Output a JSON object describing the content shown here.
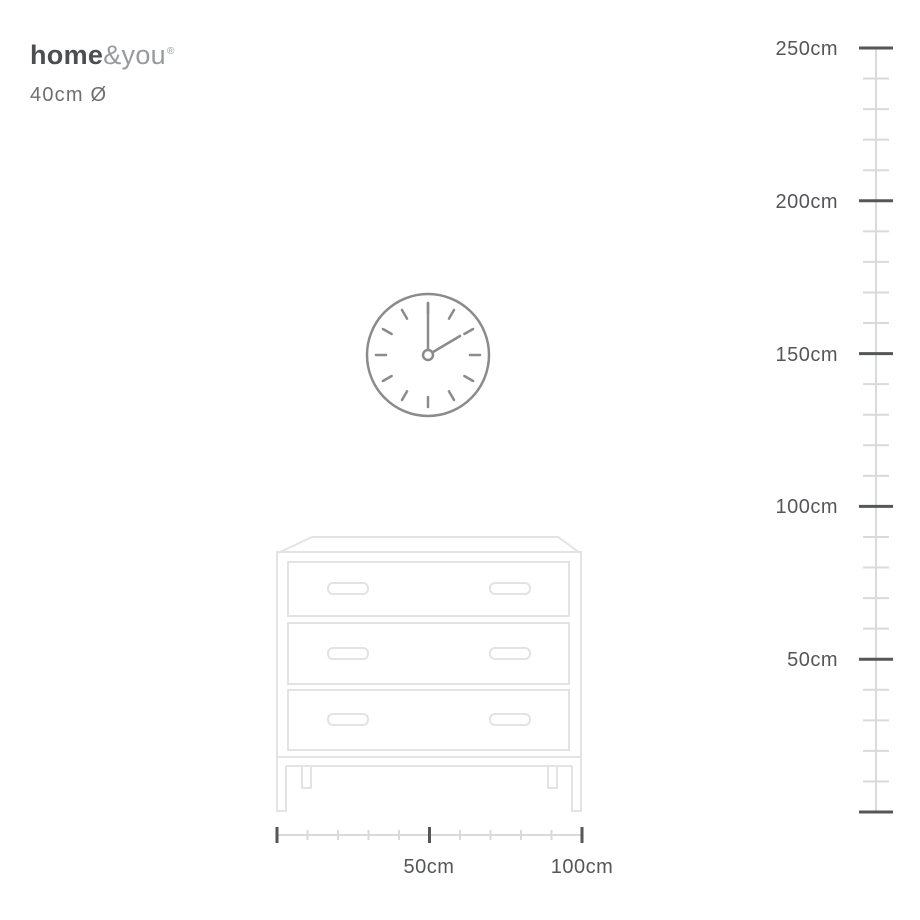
{
  "brand": {
    "name": "home&you",
    "logo_bold": "home",
    "logo_light": "&you",
    "registered_mark": "®"
  },
  "product": {
    "dimension_label": "40cm Ø"
  },
  "vertical_ruler": {
    "unit": "cm",
    "minor_ticks_per_segment": 4,
    "labels": [
      {
        "text": "250cm"
      },
      {
        "text": "200cm"
      },
      {
        "text": "150cm"
      },
      {
        "text": "100cm"
      },
      {
        "text": "50cm"
      }
    ]
  },
  "horizontal_ruler": {
    "unit": "cm",
    "minor_ticks_per_segment": 4,
    "labels": [
      {
        "text": "50cm"
      },
      {
        "text": "100cm"
      }
    ]
  },
  "scene": {
    "clock": {
      "shown_time": "2:00",
      "diameter_label": "40cm"
    },
    "furniture": "three-drawer dresser"
  },
  "colors": {
    "ink_dark": "#55565A",
    "ink_medium": "#6E6F72",
    "logo_dark": "#4D4E50",
    "logo_light": "#97999C",
    "ruler_light": "#D9DADC",
    "clock_stroke": "#8A8B8D",
    "furniture_stroke": "#E3E3E4",
    "background": "#FFFFFF"
  }
}
